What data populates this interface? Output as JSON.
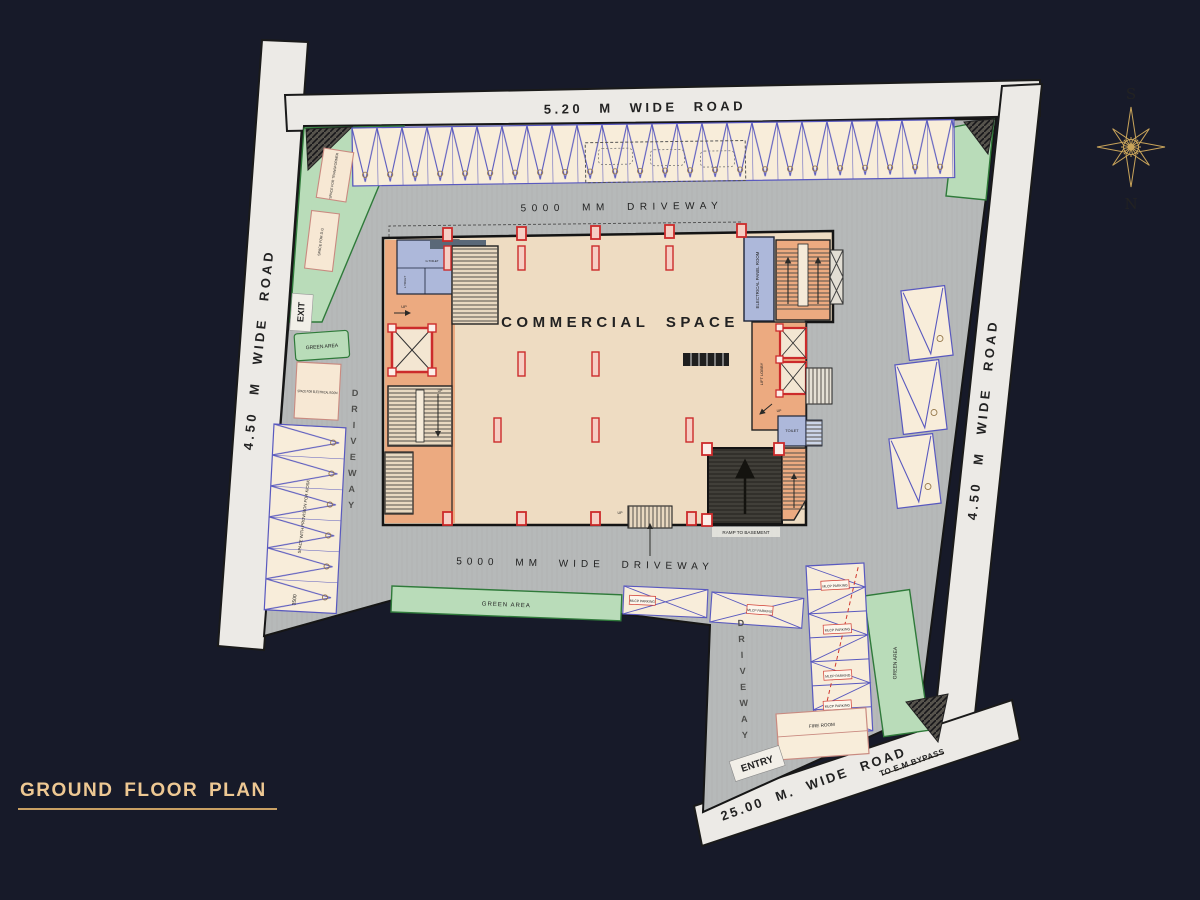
{
  "title": {
    "text": "GROUND FLOOR PLAN"
  },
  "compass": {
    "south": "S",
    "north": "N"
  },
  "roads": {
    "top": "5.20 M WIDE ROAD",
    "left": "4.50 M WIDE ROAD",
    "right": "4.50 M WIDE ROAD",
    "bottom": "25.00 M. WIDE ROAD",
    "bypass": "TO E.M BYPASS"
  },
  "driveways": {
    "top": "5000 MM DRIVEWAY",
    "bottom": "5000 MM WIDE DRIVEWAY",
    "left_vertical": "DRIVEWAY",
    "corridor_vertical": "DRIVEWAY"
  },
  "building": {
    "commercial_space": "COMMERCIAL SPACE",
    "electrical_panel_room": "ELECTRICAL PANEL ROOM",
    "lift_lobby": "LIFT LOBBY",
    "toilet": "TOILET",
    "g_toilet": "G.TOILET",
    "l_toilet": "L.TOILET",
    "ramp_to_basement": "RAMP TO BASEMENT",
    "up": "UP"
  },
  "site": {
    "entry": "ENTRY",
    "exit": "EXIT",
    "green_area": "GREEN AREA",
    "space_for_transformer": "SPACE FOR TRANSFORMER",
    "space_for_dg": "SPACE FOR D.G",
    "space_for_electrical_room": "SPACE FOR ELECTRICAL ROOM",
    "kiosk_strip": "SPACE WITH PROVISION FOR KIOSK",
    "dimension_3500": "3500",
    "fire_room": "FIRE ROOM",
    "parking_tag": "MLCP PARKING"
  },
  "colors": {
    "background_navy": "#171a29",
    "accent_gold": "#c9a45a",
    "title_gold": "#eec893",
    "stall_line_blue": "#5959bf",
    "column_red": "#cc2b2b",
    "green_area_fill": "#b9dcb9",
    "driveway_gray": "#b6b9b9",
    "building_cream": "#eedcc2",
    "core_salmon": "#ecaa80",
    "room_lavender": "#adb8da"
  }
}
